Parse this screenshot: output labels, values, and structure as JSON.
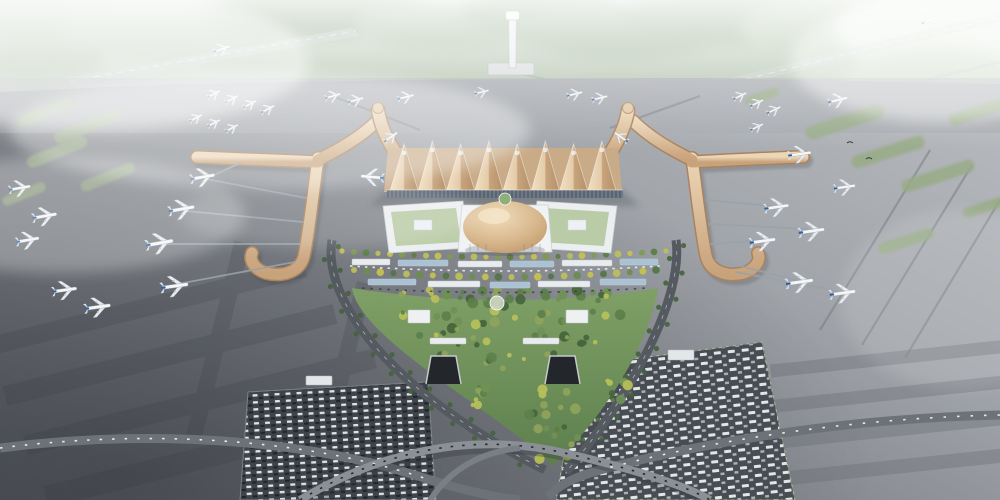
{
  "meta": {
    "title": "Aerial architectural rendering of an airport terminal complex",
    "description": "Bird's-eye visualization: golden pleated-roof terminal with Y-shaped piers, central golden dome, green landside park, looping access roads, parking lots, aprons with parked aircraft, misty forest horizon with control tower"
  },
  "palette": {
    "roof_gold_light": "#f2dfc2",
    "roof_gold_dark": "#b5916a",
    "pier_gold_light": "#ecd6b6",
    "pier_gold_dark": "#c8a27b",
    "dome_gold": "#d9b98e",
    "apron_dark": "#5a5e64",
    "apron_light": "#b4b7bb",
    "forest_green": "#9fb69a",
    "park_green": "#6f9156",
    "tree_yellow": "#b9c05a",
    "tree_dark": "#45653b",
    "road_gray": "#555a61",
    "plane_tail_blue": "#2d5fa6",
    "mist_white": "#ffffff"
  },
  "scene": {
    "aircraft": [
      [
        214,
        94,
        -28,
        0.5
      ],
      [
        232,
        99,
        -28,
        0.5
      ],
      [
        250,
        104,
        -28,
        0.5
      ],
      [
        268,
        109,
        -28,
        0.52
      ],
      [
        196,
        118,
        -28,
        0.48
      ],
      [
        214,
        123,
        -28,
        0.48
      ],
      [
        232,
        128,
        -28,
        0.48
      ],
      [
        222,
        49,
        -20,
        0.6
      ],
      [
        333,
        96,
        -16,
        0.55
      ],
      [
        356,
        100,
        -16,
        0.55
      ],
      [
        406,
        97,
        -14,
        0.58
      ],
      [
        482,
        92,
        -14,
        0.5
      ],
      [
        575,
        94,
        -14,
        0.55
      ],
      [
        600,
        98,
        -14,
        0.55
      ],
      [
        740,
        96,
        -26,
        0.5
      ],
      [
        757,
        103,
        -26,
        0.5
      ],
      [
        774,
        110,
        -26,
        0.52
      ],
      [
        757,
        127,
        -26,
        0.48
      ],
      [
        838,
        100,
        -14,
        0.68
      ],
      [
        930,
        20,
        -24,
        0.6
      ],
      [
        203,
        177,
        -10,
        0.85
      ],
      [
        182,
        209,
        -10,
        0.9
      ],
      [
        160,
        243,
        -10,
        0.95
      ],
      [
        175,
        286,
        -8,
        0.95
      ],
      [
        98,
        307,
        -8,
        0.9
      ],
      [
        45,
        216,
        -10,
        0.85
      ],
      [
        20,
        188,
        -10,
        0.75
      ],
      [
        28,
        240,
        -10,
        0.8
      ],
      [
        65,
        290,
        -8,
        0.85
      ],
      [
        372,
        177,
        185,
        0.8
      ],
      [
        391,
        137,
        -35,
        0.55
      ],
      [
        621,
        137,
        -145,
        0.55
      ],
      [
        800,
        154,
        -8,
        0.8
      ],
      [
        845,
        187,
        -8,
        0.75
      ],
      [
        777,
        207,
        -8,
        0.85
      ],
      [
        812,
        231,
        -8,
        0.9
      ],
      [
        763,
        241,
        -8,
        0.9
      ],
      [
        800,
        282,
        -8,
        0.95
      ],
      [
        843,
        293,
        -8,
        0.9
      ]
    ],
    "green_islands": [
      [
        45,
        112,
        60,
        12,
        -22
      ],
      [
        88,
        126,
        72,
        12,
        -22
      ],
      [
        57,
        152,
        64,
        12,
        -22
      ],
      [
        108,
        177,
        58,
        11,
        -22
      ],
      [
        24,
        194,
        46,
        10,
        -22
      ],
      [
        845,
        122,
        82,
        14,
        -18
      ],
      [
        888,
        152,
        76,
        13,
        -18
      ],
      [
        938,
        176,
        76,
        13,
        -18
      ],
      [
        977,
        112,
        58,
        12,
        -18
      ],
      [
        988,
        206,
        52,
        10,
        -18
      ],
      [
        906,
        241,
        58,
        11,
        -18
      ],
      [
        762,
        96,
        36,
        9,
        -20
      ]
    ],
    "tree_rows": [
      {
        "x0": 342,
        "x1": 666,
        "y": 251,
        "bow": 6,
        "count": 28,
        "r": 2.6,
        "palette": [
          "#c6c14f",
          "#7f9b52",
          "#5d7d45",
          "#b9c05a"
        ]
      },
      {
        "x0": 354,
        "x1": 656,
        "y": 270,
        "bow": 7,
        "count": 24,
        "r": 3,
        "palette": [
          "#b9c05a",
          "#6c8d50",
          "#c6c14f",
          "#55754a"
        ]
      }
    ],
    "tree_palette": [
      "#45653b",
      "#5d7f4a",
      "#6f9156",
      "#b9c05a",
      "#8fa35c"
    ],
    "tree_clusters": [
      {
        "x": 505,
        "y": 296,
        "rx": 140,
        "ry": 8,
        "n": 34,
        "seed": 3
      },
      {
        "x": 505,
        "y": 315,
        "rx": 120,
        "ry": 10,
        "n": 22,
        "seed": 11
      },
      {
        "x": 450,
        "y": 342,
        "rx": 40,
        "ry": 14,
        "n": 12,
        "seed": 5
      },
      {
        "x": 560,
        "y": 342,
        "rx": 40,
        "ry": 14,
        "n": 12,
        "seed": 8
      },
      {
        "x": 505,
        "y": 360,
        "rx": 20,
        "ry": 10,
        "n": 6,
        "seed": 2
      },
      {
        "x": 553,
        "y": 425,
        "rx": 26,
        "ry": 40,
        "n": 20,
        "seed": 9
      },
      {
        "x": 480,
        "y": 395,
        "rx": 18,
        "ry": 12,
        "n": 8,
        "seed": 4
      },
      {
        "x": 615,
        "y": 390,
        "rx": 16,
        "ry": 12,
        "n": 7,
        "seed": 6
      }
    ],
    "canopies": [
      [
        352,
        259,
        38,
        6,
        0
      ],
      [
        398,
        260,
        50,
        6,
        1
      ],
      [
        458,
        261,
        44,
        6,
        0
      ],
      [
        510,
        261,
        44,
        6,
        1
      ],
      [
        562,
        260,
        50,
        6,
        0
      ],
      [
        620,
        259,
        38,
        6,
        1
      ],
      [
        368,
        279,
        48,
        6,
        1
      ],
      [
        428,
        281,
        52,
        6,
        0
      ],
      [
        490,
        282,
        40,
        6,
        1
      ],
      [
        538,
        281,
        52,
        6,
        0
      ],
      [
        600,
        279,
        46,
        6,
        1
      ]
    ],
    "jet_bridges": [
      [
        240,
        163,
        214,
        175
      ],
      [
        306,
        198,
        206,
        179
      ],
      [
        303,
        222,
        186,
        211
      ],
      [
        300,
        244,
        164,
        244
      ],
      [
        295,
        262,
        178,
        284
      ],
      [
        706,
        200,
        773,
        206
      ],
      [
        709,
        224,
        808,
        229
      ],
      [
        711,
        244,
        766,
        240
      ],
      [
        716,
        260,
        796,
        280
      ],
      [
        736,
        272,
        838,
        291
      ]
    ],
    "birds": [
      [
        850,
        143
      ],
      [
        869,
        159
      ]
    ]
  }
}
